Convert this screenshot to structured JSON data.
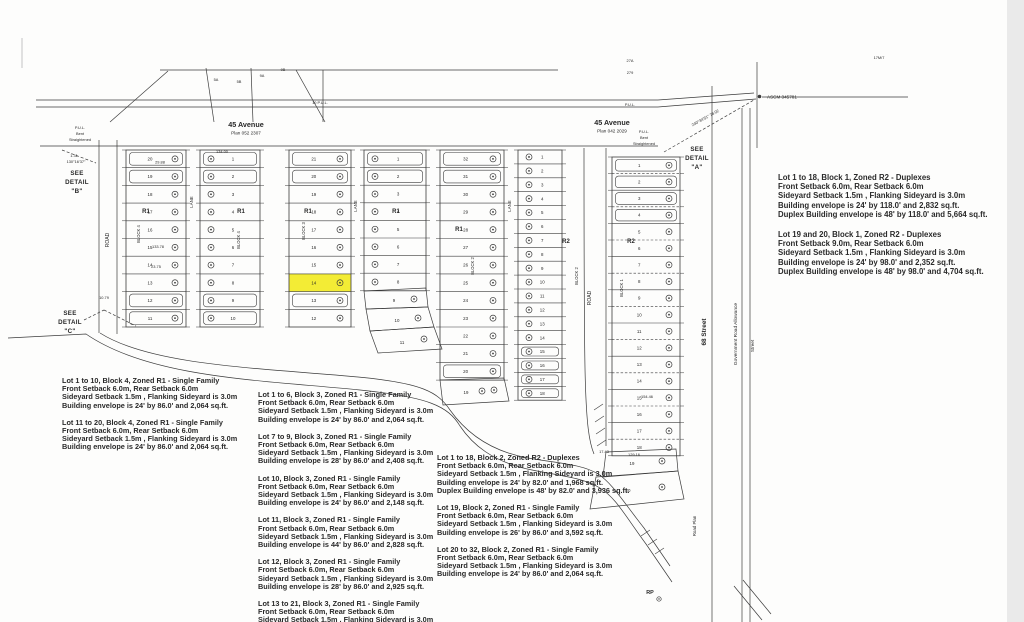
{
  "streets": {
    "avenue_left": {
      "name": "45 Avenue",
      "plan": "Plan 052 2307"
    },
    "avenue_right": {
      "name": "45 Avenue",
      "plan": "Plan 042 2029"
    },
    "street_68": "68 Street",
    "gov_road_allowance": "Government Road Allowance",
    "street_small": "Street",
    "road_plan": "Road Plan",
    "road_left": "ROAD",
    "road_right": "ROAD",
    "lane_block4": "LANE",
    "lane_block3": "LANE",
    "lane_block2": "LANE"
  },
  "details": {
    "a": [
      "SEE",
      "DETAIL",
      "\"A\""
    ],
    "b": [
      "SEE",
      "DETAIL",
      "\"B\""
    ],
    "c": [
      "SEE",
      "DETAIL",
      "\"C\""
    ]
  },
  "markers": {
    "monument": "ASCM 345781",
    "rp": "RP",
    "pul_left": [
      "P.U.L.",
      "Bent",
      "Straightened"
    ],
    "pul_right": [
      "P.U.L.",
      "Bent",
      "Straightened"
    ],
    "pul_road_1": "10 P.U.L.",
    "pul_road_2": "P.U.L.",
    "angle_b_len": "1.31",
    "angle_b": "130°16'37\"",
    "angle_a": "240°34'51\"  78.02"
  },
  "dims": {
    "d1": "134.00",
    "d2": "29.88",
    "d3": "133.78",
    "d4": "23.75",
    "d5": "154.46",
    "d6": "129.16",
    "d7": "17.43",
    "d8": "10.79",
    "t1": "27A",
    "t2": "279",
    "t3": "17M/7",
    "t4": "5A",
    "t5": "5B",
    "t6": "9A",
    "t7": "9B"
  },
  "blocks": [
    {
      "name": "BLOCK 4",
      "zone_left": "R1",
      "zone_right": "R1",
      "left": [
        20,
        19,
        18,
        17,
        16,
        15,
        14,
        13,
        12,
        11
      ],
      "right": [
        1,
        2,
        3,
        4,
        5,
        6,
        7,
        8,
        9,
        10
      ]
    },
    {
      "name": "BLOCK 3",
      "zone_left": "R1",
      "zone_right": "R1",
      "left": [
        21,
        20,
        19,
        18,
        17,
        16,
        15,
        14,
        13,
        12
      ],
      "right": [
        1,
        2,
        3,
        4,
        5,
        6,
        7,
        8
      ],
      "extra": [
        9,
        10,
        11
      ],
      "highlighted_lot": 14,
      "highlight_color": "#f3ec35"
    },
    {
      "name": "BLOCK 2",
      "zone_left": "R1",
      "zone_right": "R2",
      "left": [
        32,
        31,
        30,
        29,
        28,
        27,
        26,
        25,
        24,
        23,
        22,
        21,
        20
      ],
      "right": [
        1,
        2,
        3,
        4,
        5,
        6,
        7,
        8,
        9,
        10,
        11,
        12,
        13,
        14,
        15,
        16,
        17,
        18
      ],
      "extra": [
        19
      ]
    },
    {
      "name": "BLOCK 1",
      "zone": "R2",
      "col": [
        1,
        2,
        3,
        4,
        5,
        6,
        7,
        8,
        9,
        10,
        11,
        12,
        13,
        14,
        15,
        16,
        17,
        18
      ],
      "extra": [
        19,
        20
      ]
    }
  ],
  "notes_block4": [
    {
      "lines": [
        "Lot 1 to 10, Block 4, Zoned R1 - Single Family",
        "Front Setback 6.0m, Rear Setback 6.0m",
        "Sideyard Setback 1.5m , Flanking Sideyard is 3.0m",
        "Building envelope is 24' by 86.0'  and 2,064 sq.ft."
      ]
    },
    {
      "lines": [
        "Lot 11 to 20, Block 4, Zoned R1 - Single Family",
        "Front Setback 6.0m, Rear Setback 6.0m",
        "Sideyard Setback 1.5m , Flanking Sideyard is 3.0m",
        "Building envelope is 24' by 86.0'  and 2,064 sq.ft."
      ]
    }
  ],
  "notes_block3": [
    {
      "lines": [
        "Lot 1 to 6, Block 3, Zoned R1 - Single Family",
        "Front Setback 6.0m, Rear Setback 6.0m",
        "Sideyard Setback 1.5m , Flanking Sideyard is 3.0m",
        "Building envelope is 24' by 86.0'  and 2,064 sq.ft."
      ]
    },
    {
      "lines": [
        "Lot 7 to 9, Block 3, Zoned R1 - Single Family",
        "Front Setback 6.0m, Rear Setback 6.0m",
        "Sideyard Setback 1.5m , Flanking Sideyard is 3.0m",
        "Building envelope is 28' by 86.0'  and 2,408 sq.ft."
      ]
    },
    {
      "lines": [
        "Lot 10, Block 3, Zoned R1 - Single Family",
        "Front Setback 6.0m, Rear Setback 6.0m",
        "Sideyard Setback 1.5m , Flanking Sideyard is 3.0m",
        "Building envelope is 24' by 86.0'  and 2,148 sq.ft."
      ]
    },
    {
      "lines": [
        "Lot 11, Block 3, Zoned R1 - Single Family",
        "Front Setback 6.0m, Rear Setback 6.0m",
        "Sideyard Setback 1.5m , Flanking Sideyard is 3.0m",
        "Building envelope is 44' by 86.0'  and 2,828 sq.ft."
      ]
    },
    {
      "lines": [
        "Lot 12, Block 3, Zoned R1 - Single Family",
        "Front Setback 6.0m, Rear Setback 6.0m",
        "Sideyard Setback 1.5m , Flanking Sideyard is 3.0m",
        "Building envelope is 28' by 86.0'  and 2,925 sq.ft."
      ]
    },
    {
      "lines": [
        "Lot 13 to 21, Block 3, Zoned R1 - Single Family",
        "Front Setback 6.0m, Rear Setback 6.0m",
        "Sideyard Setback 1.5m , Flanking Sideyard is 3.0m"
      ]
    }
  ],
  "notes_block2": [
    {
      "lines": [
        "Lot 1 to 18, Block 2, Zoned R2 - Duplexes",
        "Front Setback 6.0m, Rear Setback 6.0m",
        "Sideyard Setback 1.5m , Flanking Sideyard is 3.0m",
        "Building envelope is 24' by 82.0'  and 1,968 sq.ft.",
        "Duplex Building envelope is 48' by 82.0'  and 3,936 sq.ft."
      ]
    },
    {
      "lines": [
        "Lot 19, Block 2, Zoned R1 - Single Family",
        "Front Setback 6.0m, Rear Setback 6.0m",
        "Sideyard Setback 1.5m , Flanking Sideyard is 3.0m",
        "Building envelope is 26' by 86.0'  and 3,592 sq.ft."
      ]
    },
    {
      "lines": [
        "Lot 20 to 32, Block 2, Zoned R1 - Single Family",
        "Front Setback 6.0m, Rear Setback 6.0m",
        "Sideyard Setback 1.5m , Flanking Sideyard is 3.0m",
        "Building envelope is 24' by 86.0'  and 2,064 sq.ft."
      ]
    }
  ],
  "notes_block1": [
    {
      "lines": [
        "Lot 1 to 18, Block 1, Zoned R2 - Duplexes",
        "Front Setback 6.0m, Rear Setback 6.0m",
        "Sideyard Setback 1.5m , Flanking Sideyard is 3.0m",
        "Building envelope is 24' by 118.0'  and 2,832 sq.ft.",
        "Duplex Building envelope is 48' by 118.0'  and 5,664 sq.ft."
      ]
    },
    {
      "lines": [
        "Lot 19 and 20, Block 1, Zoned R2 - Duplexes",
        "Front Setback 9.0m, Rear Setback 6.0m",
        "Sideyard Setback 1.5m , Flanking Sideyard is 3.0m",
        "Building envelope is 24' by 98.0'  and 2,352 sq.ft.",
        "Duplex Building envelope is 48' by 98.0'  and 4,704 sq.ft."
      ]
    }
  ]
}
